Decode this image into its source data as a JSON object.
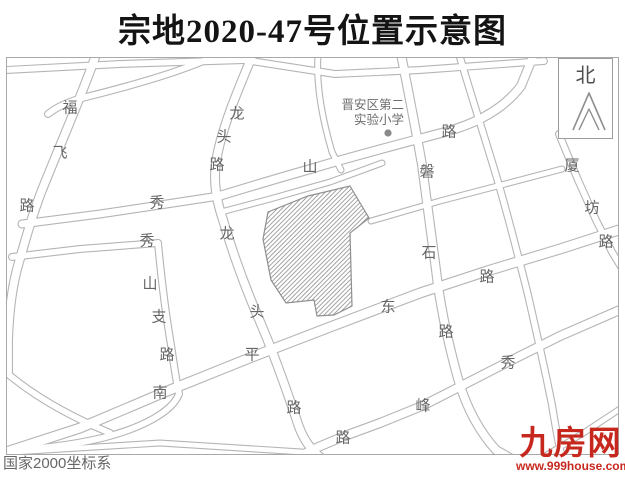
{
  "title": "宗地2020-47号位置示意图",
  "map": {
    "parcel_name": "宗地2020-47",
    "north_label": "北",
    "school": {
      "line1": "晋安区第二",
      "line2": "实验小学"
    },
    "coordinate_note": "国家2000坐标系",
    "road_labels": [
      {
        "name": "福飞路",
        "chars": [
          {
            "t": "福",
            "x": 63,
            "y": 49
          },
          {
            "t": "飞",
            "x": 53,
            "y": 94
          },
          {
            "t": "路",
            "x": 20,
            "y": 147
          }
        ]
      },
      {
        "name": "龙头路-上",
        "chars": [
          {
            "t": "龙",
            "x": 230,
            "y": 55
          },
          {
            "t": "头",
            "x": 217,
            "y": 78
          },
          {
            "t": "路",
            "x": 210,
            "y": 106
          }
        ]
      },
      {
        "name": "龙头路-下",
        "chars": [
          {
            "t": "龙",
            "x": 220,
            "y": 175
          },
          {
            "t": "头",
            "x": 250,
            "y": 253
          },
          {
            "t": "路",
            "x": 287,
            "y": 349
          }
        ]
      },
      {
        "name": "秀山路",
        "chars": [
          {
            "t": "秀",
            "x": 150,
            "y": 144
          },
          {
            "t": "山",
            "x": 303,
            "y": 108
          },
          {
            "t": "路",
            "x": 442,
            "y": 73
          }
        ]
      },
      {
        "name": "秀山支路",
        "chars": [
          {
            "t": "秀",
            "x": 140,
            "y": 182
          },
          {
            "t": "山",
            "x": 143,
            "y": 225
          },
          {
            "t": "支",
            "x": 152,
            "y": 258
          },
          {
            "t": "路",
            "x": 160,
            "y": 296
          }
        ]
      },
      {
        "name": "南平东路",
        "chars": [
          {
            "t": "南",
            "x": 153,
            "y": 334
          },
          {
            "t": "平",
            "x": 245,
            "y": 296
          },
          {
            "t": "东",
            "x": 381,
            "y": 248
          },
          {
            "t": "路",
            "x": 480,
            "y": 218
          }
        ]
      },
      {
        "name": "磐石路",
        "chars": [
          {
            "t": "磐",
            "x": 420,
            "y": 113
          },
          {
            "t": "石",
            "x": 422,
            "y": 194
          },
          {
            "t": "路",
            "x": 439,
            "y": 273
          }
        ]
      },
      {
        "name": "秀峰路",
        "chars": [
          {
            "t": "秀",
            "x": 501,
            "y": 304
          },
          {
            "t": "峰",
            "x": 416,
            "y": 347
          },
          {
            "t": "路",
            "x": 336,
            "y": 379
          }
        ]
      },
      {
        "name": "厦坊路",
        "chars": [
          {
            "t": "厦",
            "x": 565,
            "y": 107
          },
          {
            "t": "坊",
            "x": 585,
            "y": 149
          },
          {
            "t": "路",
            "x": 599,
            "y": 183
          }
        ]
      }
    ]
  },
  "branding": {
    "logo_text": "九房网",
    "logo_url": "www.999house.com",
    "logo_color": "#c7281e"
  },
  "colors": {
    "road_line": "#b5b5b5",
    "label_gray": "#666666",
    "parcel_outline": "#8f8f8f",
    "parcel_hatch": "#9c9c9c",
    "title_black": "#141414"
  }
}
